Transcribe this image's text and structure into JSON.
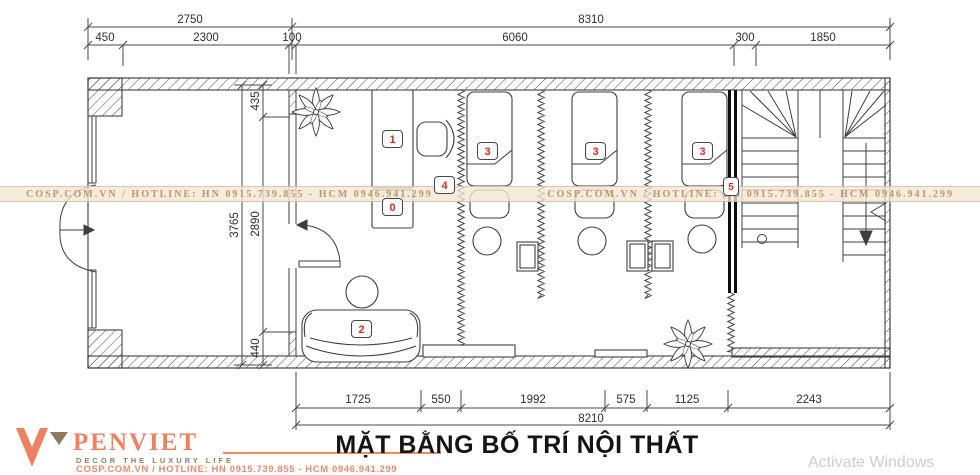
{
  "title": "MẶT BẰNG BỐ TRÍ NỘI THẤT",
  "watermark": {
    "text": "COSP.COM.VN / HOTLINE: HN 0915.739.855 - HCM 0946.941.299"
  },
  "dims": {
    "top_overall": [
      "2750",
      "8310"
    ],
    "top_chain": [
      "450",
      "2300",
      "100",
      "6060",
      "300",
      "1850"
    ],
    "left_overall": "3765",
    "left_chain": [
      "435",
      "2890",
      "440"
    ],
    "bottom_chain": [
      "1725",
      "550",
      "1992",
      "575",
      "1125",
      "2243"
    ],
    "bottom_overall": "8210"
  },
  "labels": {
    "desk": "1",
    "under_desk_cabinet": "0",
    "sofa": "2",
    "bed1": "3",
    "bed2": "3",
    "bed3": "3",
    "corner_shelf": "4",
    "wall_item": "5"
  },
  "logo": {
    "brand": "PENVIET",
    "tagline": "DECOR THE LUXURY LIFE",
    "contact": "COSP.COM.VN / HOTLINE: HN 0915.739.855 - HCM 0946.941.299"
  },
  "os_watermark": "Activate Windows",
  "colors": {
    "line": "#3f3f3f",
    "accent": "#ee8162",
    "label_red": "#d92b22",
    "watermark_tan": "#b3925f"
  }
}
